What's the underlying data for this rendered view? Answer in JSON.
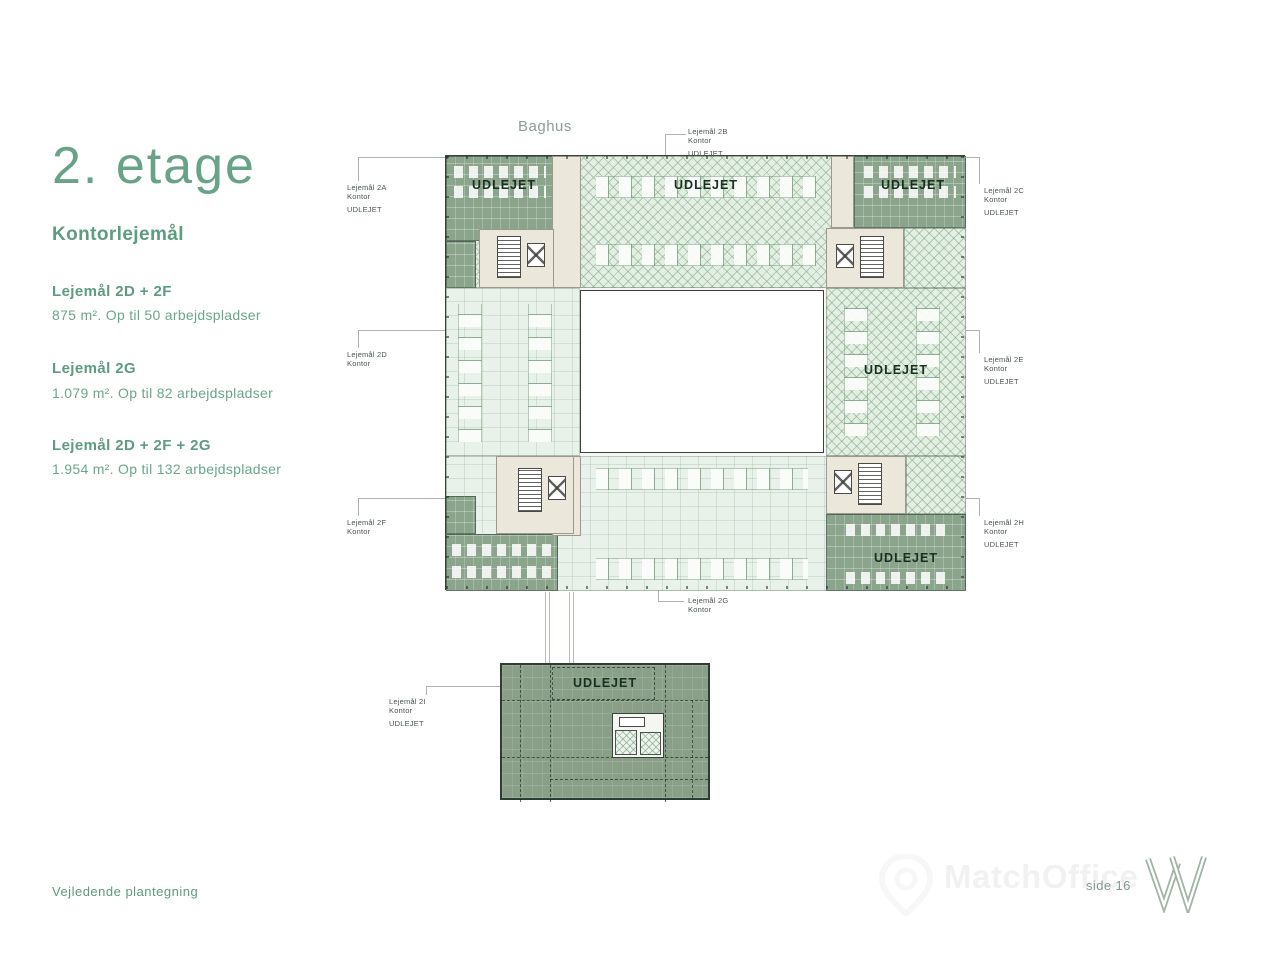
{
  "sidebar": {
    "title": "2. etage",
    "subtitle": "Kontorlejemål",
    "sections": [
      {
        "title": "Lejemål 2D + 2F",
        "desc": "875 m². Op til 50 arbejdspladser"
      },
      {
        "title": "Lejemål 2G",
        "desc": "1.079 m². Op til 82 arbejdspladser"
      },
      {
        "title": "Lejemål 2D + 2F + 2G",
        "desc": "1.954 m². Op til 132 arbejdspladser"
      }
    ]
  },
  "plan": {
    "baghus_label": "Baghus",
    "udlejet_label": "UDLEJET",
    "unit_labels": [
      {
        "id": "2A",
        "lines": [
          "Lejemål 2A",
          "Kontor",
          "UDLEJET"
        ]
      },
      {
        "id": "2B",
        "lines": [
          "Lejemål 2B",
          "Kontor",
          "UDLEJET"
        ]
      },
      {
        "id": "2C",
        "lines": [
          "Lejemål 2C",
          "Kontor",
          "UDLEJET"
        ]
      },
      {
        "id": "2D",
        "lines": [
          "Lejemål 2D",
          "Kontor"
        ]
      },
      {
        "id": "2E",
        "lines": [
          "Lejemål 2E",
          "Kontor",
          "UDLEJET"
        ]
      },
      {
        "id": "2F",
        "lines": [
          "Lejemål 2F",
          "Kontor"
        ]
      },
      {
        "id": "2G",
        "lines": [
          "Lejemål 2G",
          "Kontor"
        ]
      },
      {
        "id": "2H",
        "lines": [
          "Lejemål 2H",
          "Kontor",
          "UDLEJET"
        ]
      },
      {
        "id": "2I",
        "lines": [
          "Lejemål 2I",
          "Kontor",
          "UDLEJET"
        ]
      }
    ]
  },
  "footer": {
    "note": "Vejledende plantegning",
    "page": "side 16",
    "watermark": "MatchOffice"
  },
  "colors": {
    "accent_green": "#68a287",
    "area_rented_dark": "#8ba48c",
    "area_hatch": "#e4efe4",
    "area_open_mint": "#e9f2ea",
    "core_beige": "#ece7db"
  }
}
